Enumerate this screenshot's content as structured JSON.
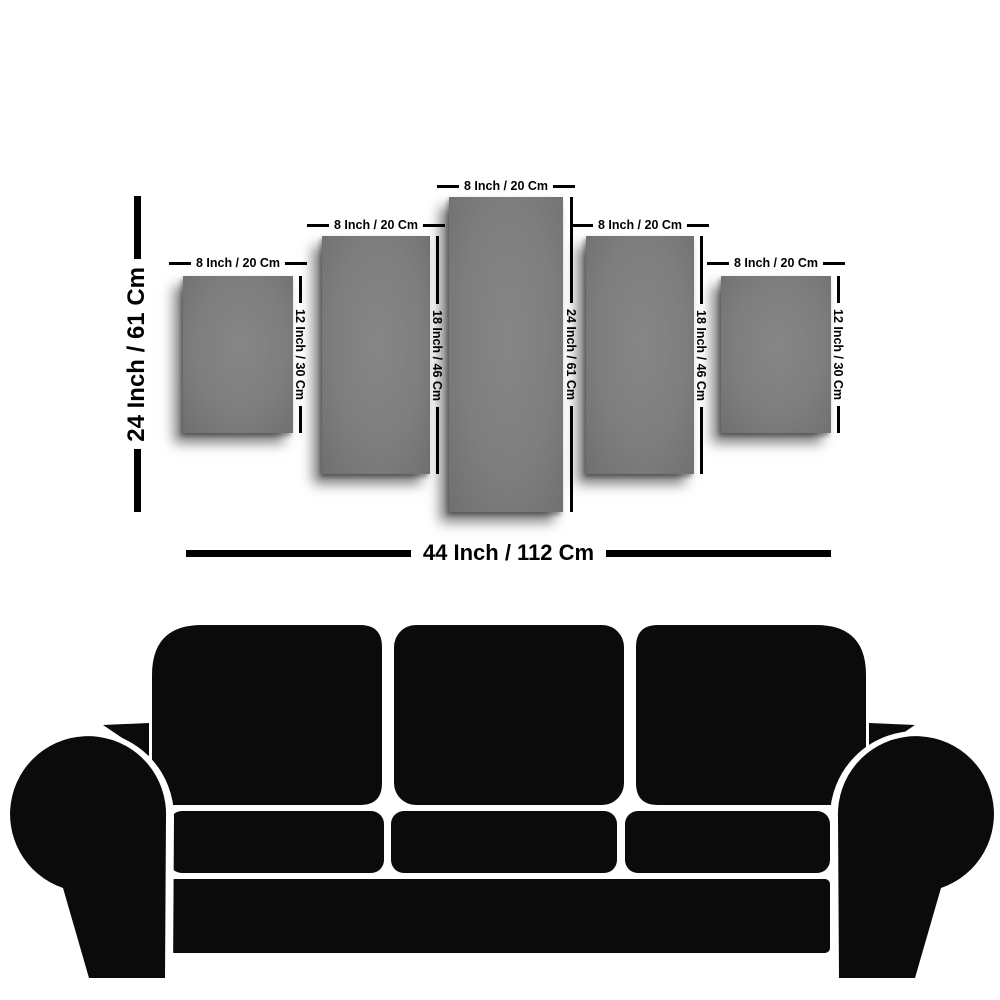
{
  "diagram": {
    "title": "five-panel-canvas-size-guide",
    "overall": {
      "height_label": "24 Inch / 61 Cm",
      "width_label": "44 Inch / 112 Cm"
    },
    "panels": [
      {
        "width_label": "8 Inch / 20 Cm",
        "height_label": "12 Inch / 30 Cm"
      },
      {
        "width_label": "8 Inch / 20 Cm",
        "height_label": "18 Inch / 46 Cm"
      },
      {
        "width_label": "8 Inch / 20 Cm",
        "height_label": "24 Inch / 61 Cm"
      },
      {
        "width_label": "8 Inch / 20 Cm",
        "height_label": "18 Inch / 46 Cm"
      },
      {
        "width_label": "8 Inch / 20 Cm",
        "height_label": "12 Inch / 30 Cm"
      }
    ],
    "colors": {
      "panel_gray": "#7e7e7e",
      "dimension_black": "#000000",
      "couch_black": "#0b0b0b",
      "background": "#ffffff"
    }
  }
}
